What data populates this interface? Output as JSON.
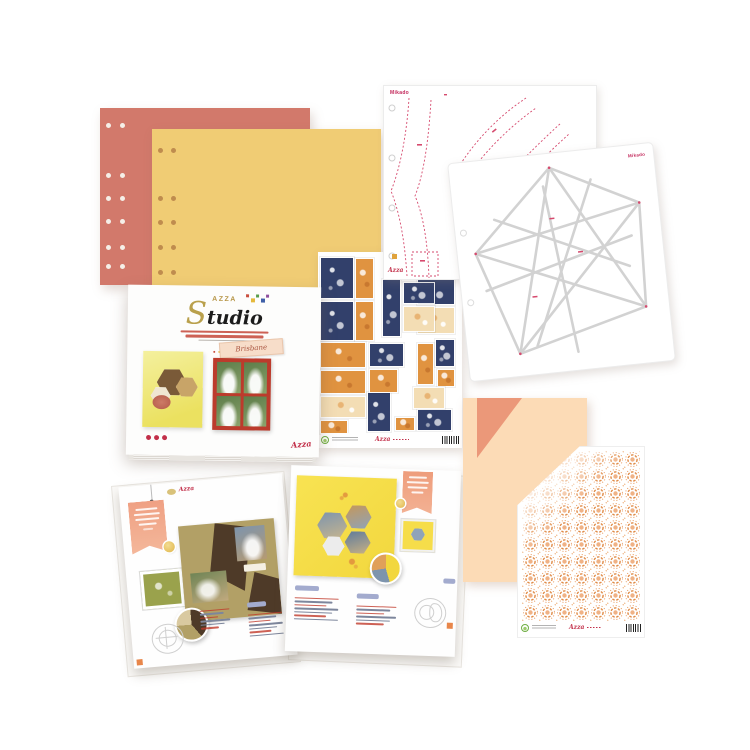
{
  "branding": {
    "brand": "AZZA",
    "signature": "Azza"
  },
  "cover": {
    "brand": "AZZA",
    "title": "Studio",
    "collection": "Brisbane",
    "confetti_colors": [
      "#c94f3f",
      "#e5b93c",
      "#5a9e4c",
      "#3f5fa8",
      "#8e4f9e"
    ],
    "tagline_color": "#c0392b",
    "dot_color": "#c22f49"
  },
  "stencils": {
    "sheet1": {
      "label": "Mikado",
      "accent": "#d64a6e"
    },
    "sheet2": {
      "label": "Mikado",
      "accent": "#d64a6e",
      "line_color": "#d2d2d2"
    }
  },
  "papers": {
    "salmon": {
      "color": "#d2796b",
      "hole_color": "#f5efe8",
      "holes": [
        [
          6,
          15
        ],
        [
          20,
          15
        ],
        [
          6,
          65
        ],
        [
          20,
          65
        ],
        [
          6,
          88
        ],
        [
          20,
          88
        ],
        [
          6,
          111
        ],
        [
          20,
          111
        ],
        [
          6,
          137
        ],
        [
          20,
          137
        ],
        [
          6,
          156
        ],
        [
          20,
          156
        ]
      ]
    },
    "yellow": {
      "color": "#f0cc74",
      "hole_color": "#bf8c4e",
      "holes": [
        [
          6,
          19
        ],
        [
          19,
          19
        ],
        [
          6,
          67
        ],
        [
          19,
          67
        ],
        [
          6,
          91
        ],
        [
          19,
          91
        ],
        [
          6,
          116
        ],
        [
          19,
          116
        ],
        [
          6,
          141
        ],
        [
          19,
          141
        ]
      ]
    },
    "peach": {
      "color": "#fcdbb6",
      "fold_color": "#eb9879"
    },
    "patterned": {
      "motif_color": "#e8975a"
    }
  },
  "stickers": {
    "colors": {
      "navy": "#32406b",
      "orange": "#e09340",
      "cream": "#f3ddb4"
    },
    "items": [
      [
        3,
        6,
        32,
        40,
        "n"
      ],
      [
        38,
        7,
        17,
        39,
        "o"
      ],
      [
        3,
        50,
        32,
        38,
        "n"
      ],
      [
        38,
        50,
        17,
        38,
        "o"
      ],
      [
        65,
        28,
        17,
        56,
        "n"
      ],
      [
        86,
        31,
        30,
        20,
        "n"
      ],
      [
        86,
        55,
        30,
        24,
        "c"
      ],
      [
        100,
        28,
        36,
        24,
        "n"
      ],
      [
        100,
        56,
        36,
        25,
        "c"
      ],
      [
        118,
        88,
        18,
        26,
        "n"
      ],
      [
        3,
        91,
        44,
        24,
        "o"
      ],
      [
        3,
        119,
        44,
        22,
        "o"
      ],
      [
        3,
        145,
        44,
        20,
        "c"
      ],
      [
        3,
        169,
        26,
        12,
        "o"
      ],
      [
        52,
        92,
        33,
        22,
        "n"
      ],
      [
        52,
        118,
        27,
        22,
        "o"
      ],
      [
        50,
        141,
        22,
        38,
        "n"
      ],
      [
        100,
        92,
        15,
        40,
        "o"
      ],
      [
        96,
        136,
        30,
        20,
        "c"
      ],
      [
        100,
        158,
        33,
        20,
        "n"
      ],
      [
        78,
        166,
        18,
        12,
        "o"
      ],
      [
        120,
        118,
        16,
        16,
        "o"
      ]
    ]
  },
  "spread": {
    "left_page": {
      "title_script": "Azza",
      "lists": [
        {
          "x": 70,
          "y": 128,
          "w": 30,
          "rows": 6,
          "chip": false
        },
        {
          "x": 118,
          "y": 118,
          "w": 34,
          "rows": 7,
          "chip": true
        }
      ]
    },
    "right_page": {
      "lists": [
        {
          "x": 8,
          "y": 112,
          "w": 44,
          "rows": 7,
          "chip": true
        },
        {
          "x": 70,
          "y": 118,
          "w": 40,
          "rows": 6,
          "chip": true
        }
      ]
    }
  }
}
